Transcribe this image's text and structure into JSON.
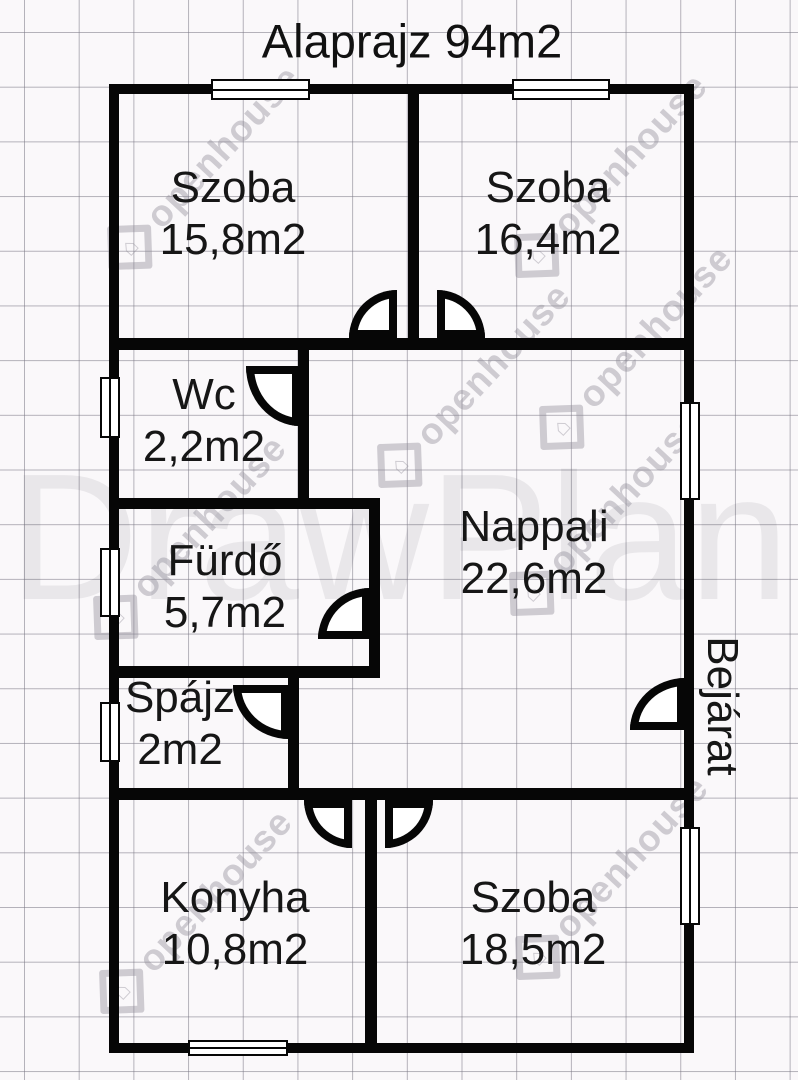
{
  "title": "Alaprajz 94m2",
  "entrance_label": "Bejárat",
  "watermark": {
    "brand": "DrawPlan",
    "tile_text": "openhouse"
  },
  "rooms": [
    {
      "name": "Szoba",
      "area": "15,8m2"
    },
    {
      "name": "Szoba",
      "area": "16,4m2"
    },
    {
      "name": "Wc",
      "area": "2,2m2"
    },
    {
      "name": "Fürdő",
      "area": "5,7m2"
    },
    {
      "name": "Nappali",
      "area": "22,6m2"
    },
    {
      "name": "Spájz",
      "area": "2m2"
    },
    {
      "name": "Konyha",
      "area": "10,8m2"
    },
    {
      "name": "Szoba",
      "area": "18,5m2"
    }
  ],
  "colors": {
    "wall": "#060606",
    "background": "#faf8fa",
    "grid": "#7a7784",
    "text": "#161616",
    "watermark": "#8d8a96"
  }
}
